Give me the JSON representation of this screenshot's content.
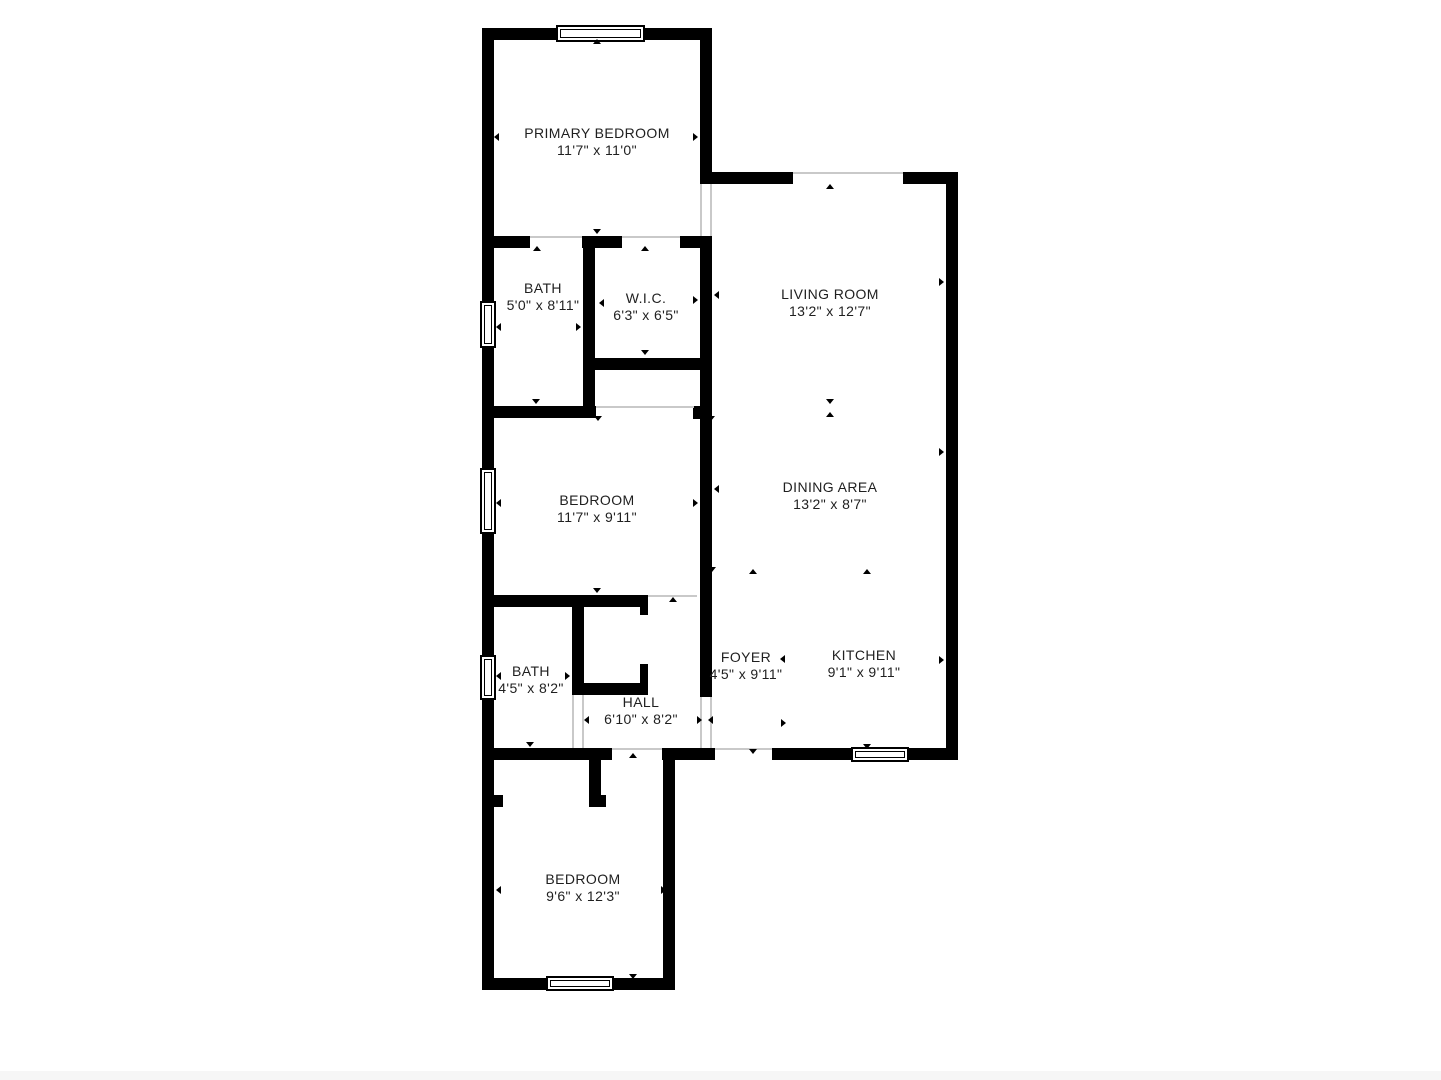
{
  "plan_title": "Apartment floor plan",
  "colors": {
    "wall": "#000000",
    "background": "#ffffff",
    "label": "#1f1f1f"
  },
  "rooms": [
    {
      "name": "PRIMARY BEDROOM",
      "dimensions": "11'7\" x 11'0\""
    },
    {
      "name": "BATH",
      "dimensions": "5'0\" x 8'11\""
    },
    {
      "name": "W.I.C.",
      "dimensions": "6'3\" x 6'5\""
    },
    {
      "name": "LIVING ROOM",
      "dimensions": "13'2\" x 12'7\""
    },
    {
      "name": "BEDROOM",
      "dimensions": "11'7\" x 9'11\""
    },
    {
      "name": "DINING AREA",
      "dimensions": "13'2\" x 8'7\""
    },
    {
      "name": "BATH",
      "dimensions": "4'5\" x 8'2\""
    },
    {
      "name": "HALL",
      "dimensions": "6'10\" x 8'2\""
    },
    {
      "name": "FOYER",
      "dimensions": "4'5\" x 9'11\""
    },
    {
      "name": "KITCHEN",
      "dimensions": "9'1\" x 9'11\""
    },
    {
      "name": "BEDROOM",
      "dimensions": "9'6\" x 12'3\""
    }
  ]
}
